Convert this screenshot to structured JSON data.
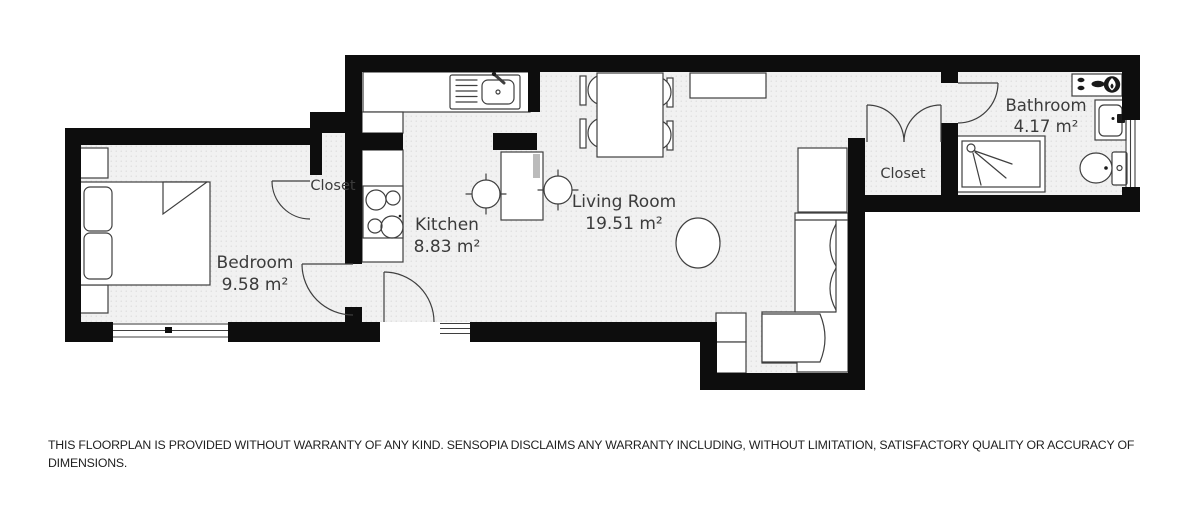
{
  "floorplan": {
    "rooms": {
      "bedroom": {
        "label": "Bedroom",
        "area": "9.58 m²"
      },
      "kitchen": {
        "label": "Kitchen",
        "area": "8.83 m²"
      },
      "living_room": {
        "label": "Living Room",
        "area": "19.51 m²"
      },
      "bedroom_closet": {
        "label": "Closet"
      },
      "hall_closet": {
        "label": "Closet"
      },
      "bathroom": {
        "label": "Bathroom",
        "area": "4.17 m²"
      }
    },
    "colors": {
      "wall": "#0d0d0d",
      "floor": "#f1f1f1",
      "floor_dot": "#d9d9d9",
      "furniture_stroke": "#3f3f3f",
      "label_text": "#3b3b3b"
    }
  },
  "disclaimer": {
    "line1": "THIS FLOORPLAN IS PROVIDED WITHOUT WARRANTY OF ANY KIND. SENSOPIA DISCLAIMS ANY WARRANTY INCLUDING, WITHOUT LIMITATION, SATISFACTORY QUALITY OR ACCURACY OF",
    "line2": "DIMENSIONS."
  }
}
